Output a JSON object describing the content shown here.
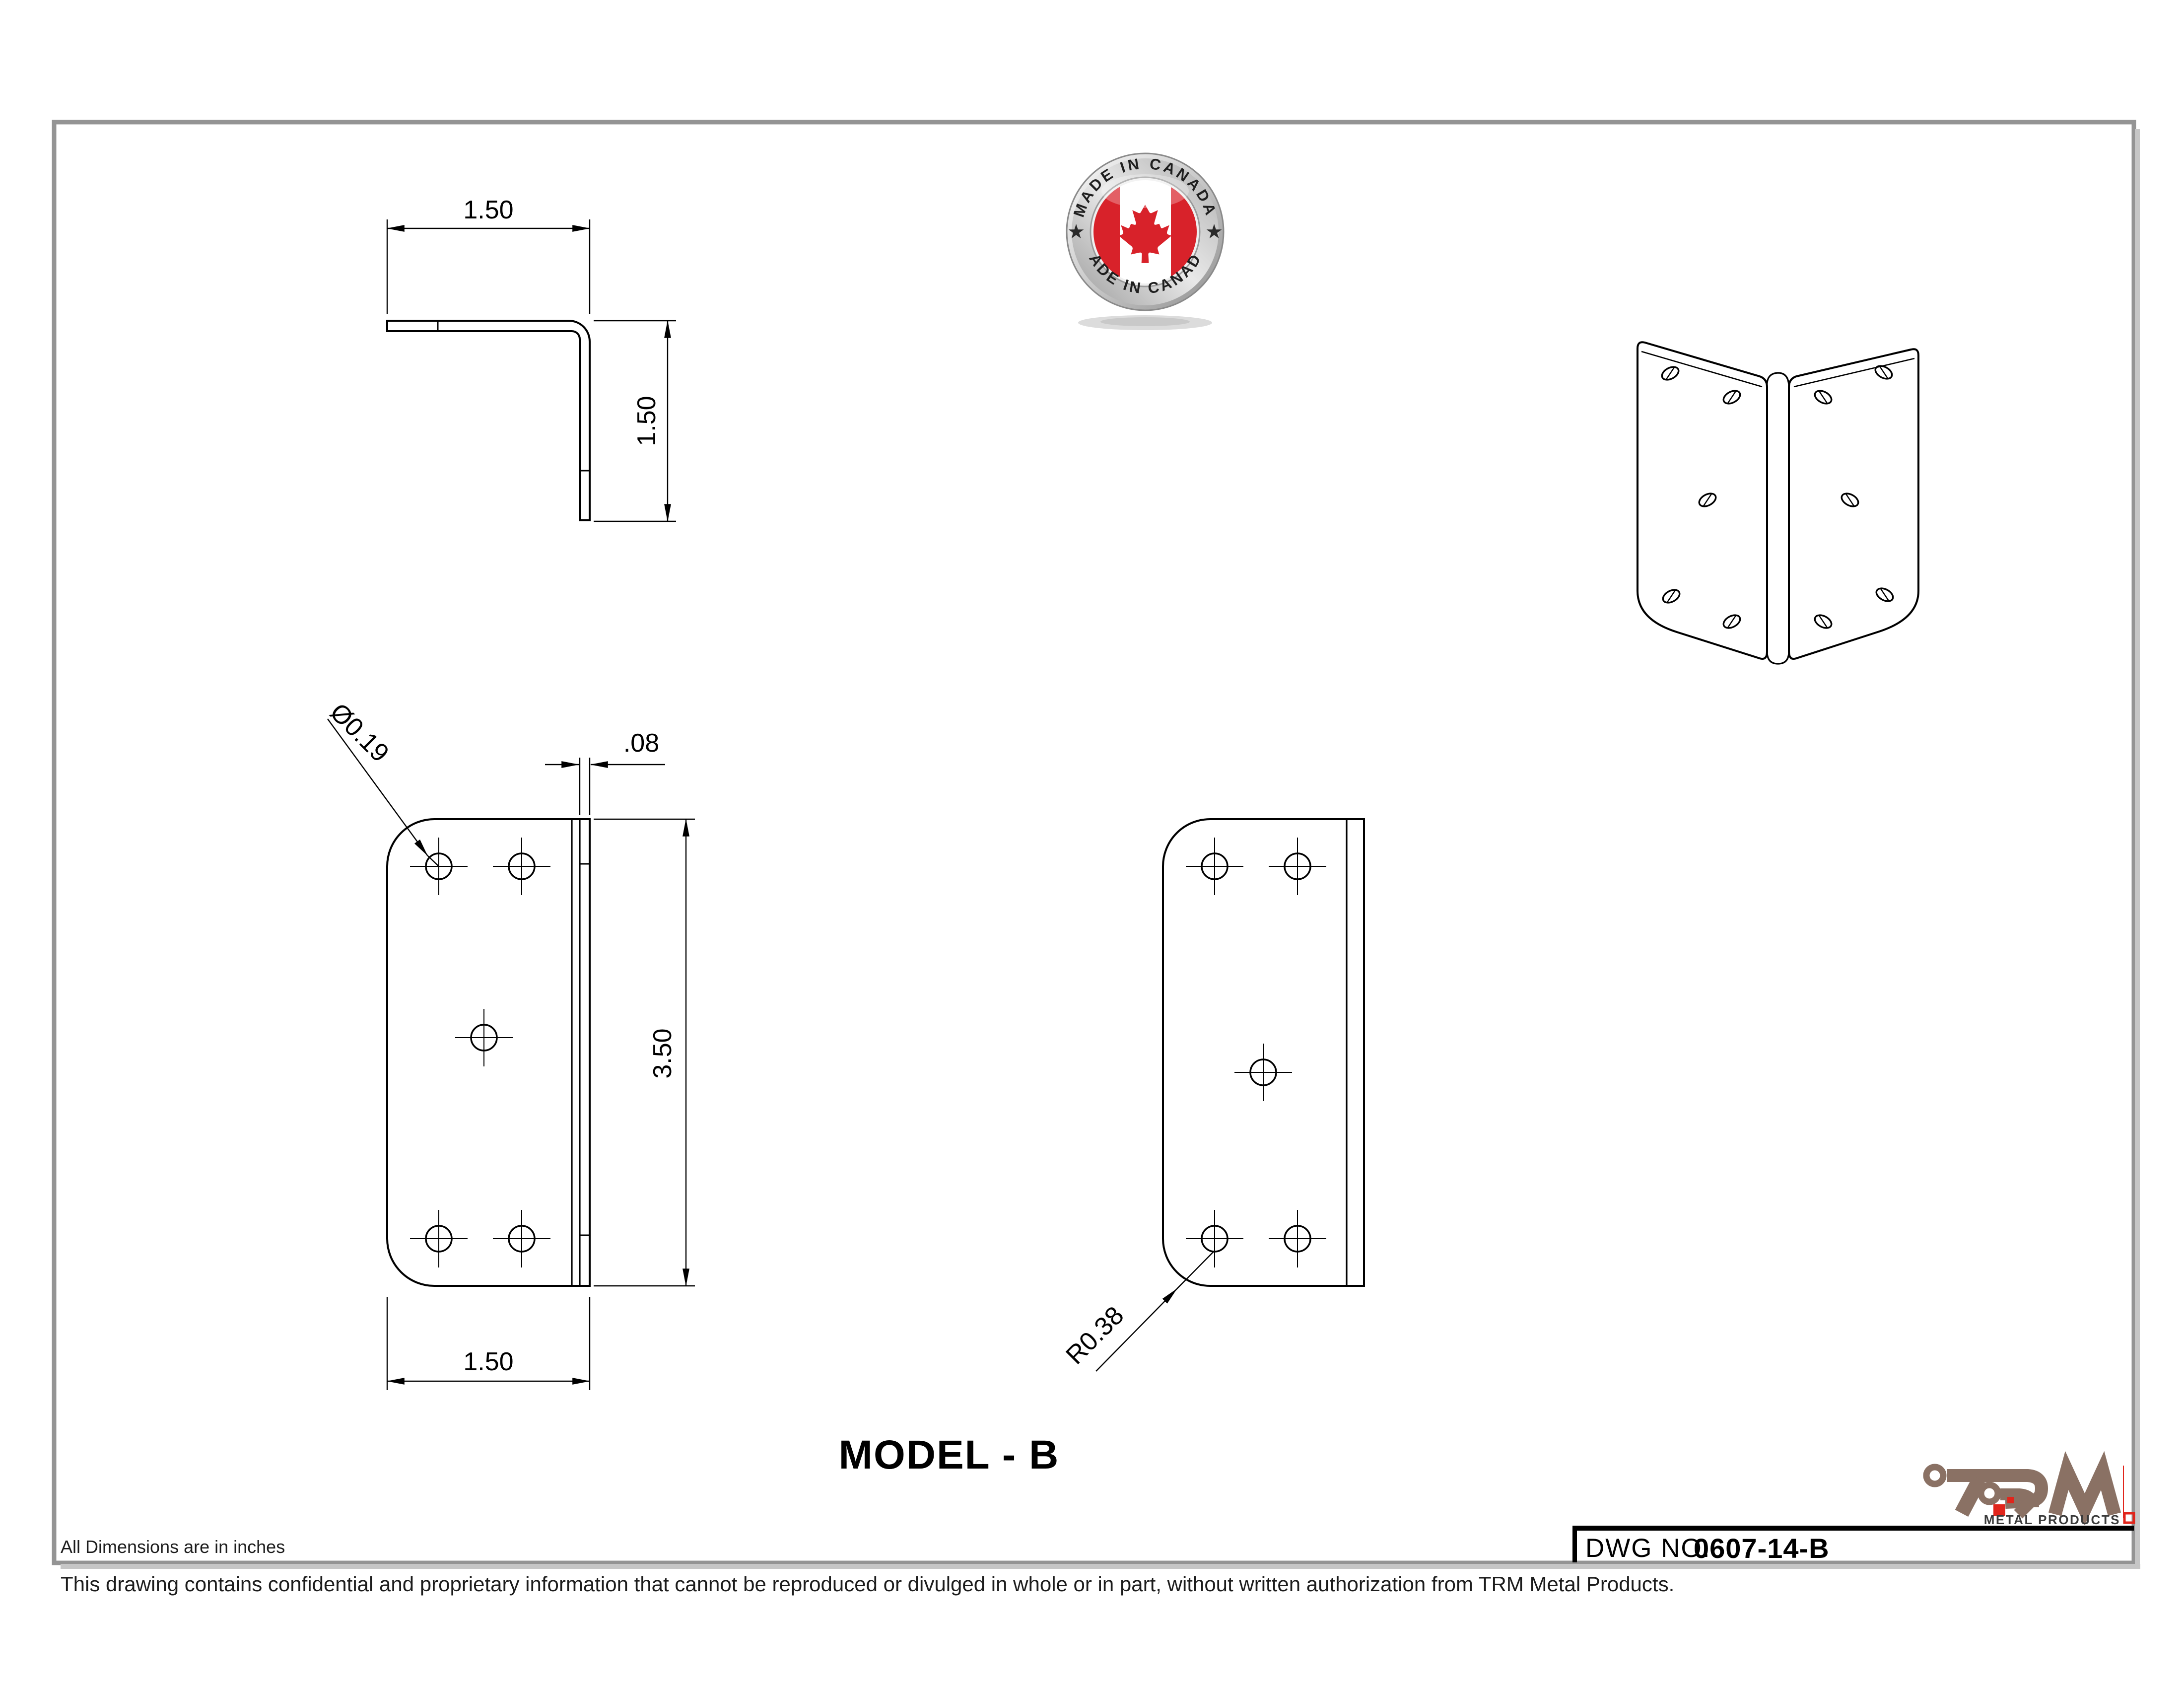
{
  "sheet": {
    "border_color": "#949494",
    "line_color": "#000000"
  },
  "badge": {
    "top_text": "MADE IN CANADA",
    "bottom_text": "MADE IN CANADA",
    "flag_red": "#d8222a",
    "ring_silver_light": "#f5f5f5",
    "ring_silver_dark": "#8f8f8f",
    "star": "★"
  },
  "title": {
    "model": "MODEL - B"
  },
  "title_block": {
    "dwg_label": "DWG NO.",
    "dwg_value": "0607-14-B"
  },
  "logo": {
    "name": "TRM",
    "subtitle": "METAL PRODUCTS",
    "brand_color": "#8a7164",
    "accent_red": "#e1251b",
    "subtitle_color": "#3b3b3b"
  },
  "notes": {
    "units": "All Dimensions are in inches",
    "confidential": "This drawing contains confidential and proprietary information that cannot be reproduced or divulged in whole or in part, without written authorization from TRM Metal Products."
  },
  "dimensions": {
    "top_width": "1.50",
    "top_height": "1.50",
    "hole_dia": "Ø0.19",
    "thickness": ".08",
    "front_height": "3.50",
    "front_width": "1.50",
    "corner_radius": "R0.38"
  }
}
